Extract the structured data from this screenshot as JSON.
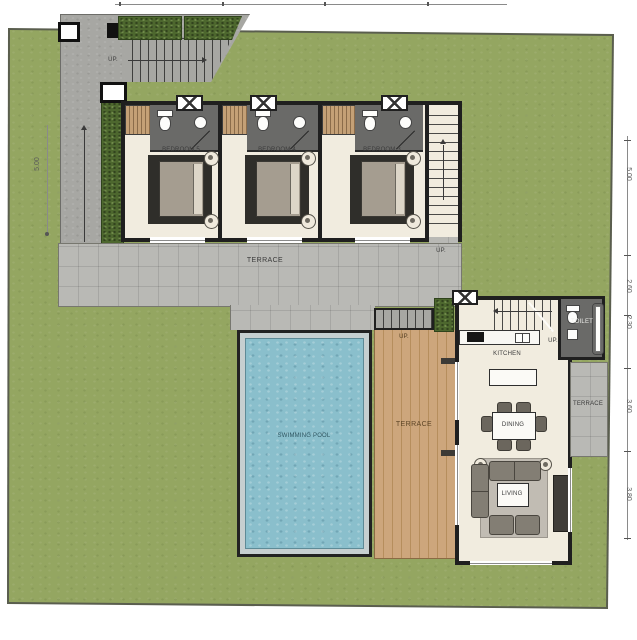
{
  "plan_title": "villa-ground-floor-plan",
  "labels": {
    "terrace_main": "TERRACE",
    "pool": "SWIMMING POOL",
    "deck": "TERRACE",
    "terrace_side": "TERRACE",
    "kitchen": "KITCHEN",
    "dining": "DINING",
    "living": "LIVING",
    "toilet": "TOILET"
  },
  "bedrooms": [
    {
      "label": "BEDROOM 5"
    },
    {
      "label": "BEDROOM 4"
    },
    {
      "label": "BEDROOM 3"
    }
  ],
  "up_labels": {
    "entry_stairs": "UP.",
    "walkway": "UP.",
    "terrace_stairs": "UP.",
    "deck_steps": "UP.",
    "house_stairs": "UP."
  },
  "dimensions": {
    "left": [
      {
        "value": "5.00"
      }
    ],
    "right": [
      {
        "value": "5.00"
      },
      {
        "value": "2.60"
      },
      {
        "value": "2.30"
      },
      {
        "value": "3.60"
      },
      {
        "value": "3.80"
      }
    ]
  },
  "colors": {
    "grass": "#94a661",
    "hedge": "#4d672e",
    "concrete": "#a7a7a3",
    "terrace_tile": "#b9b9b5",
    "wood_deck": "#cda67c",
    "pool_water": "#8abfcc",
    "wall": "#1f1f1f",
    "room_floor": "#f1ecdf",
    "bathroom": "#6a6a68"
  }
}
